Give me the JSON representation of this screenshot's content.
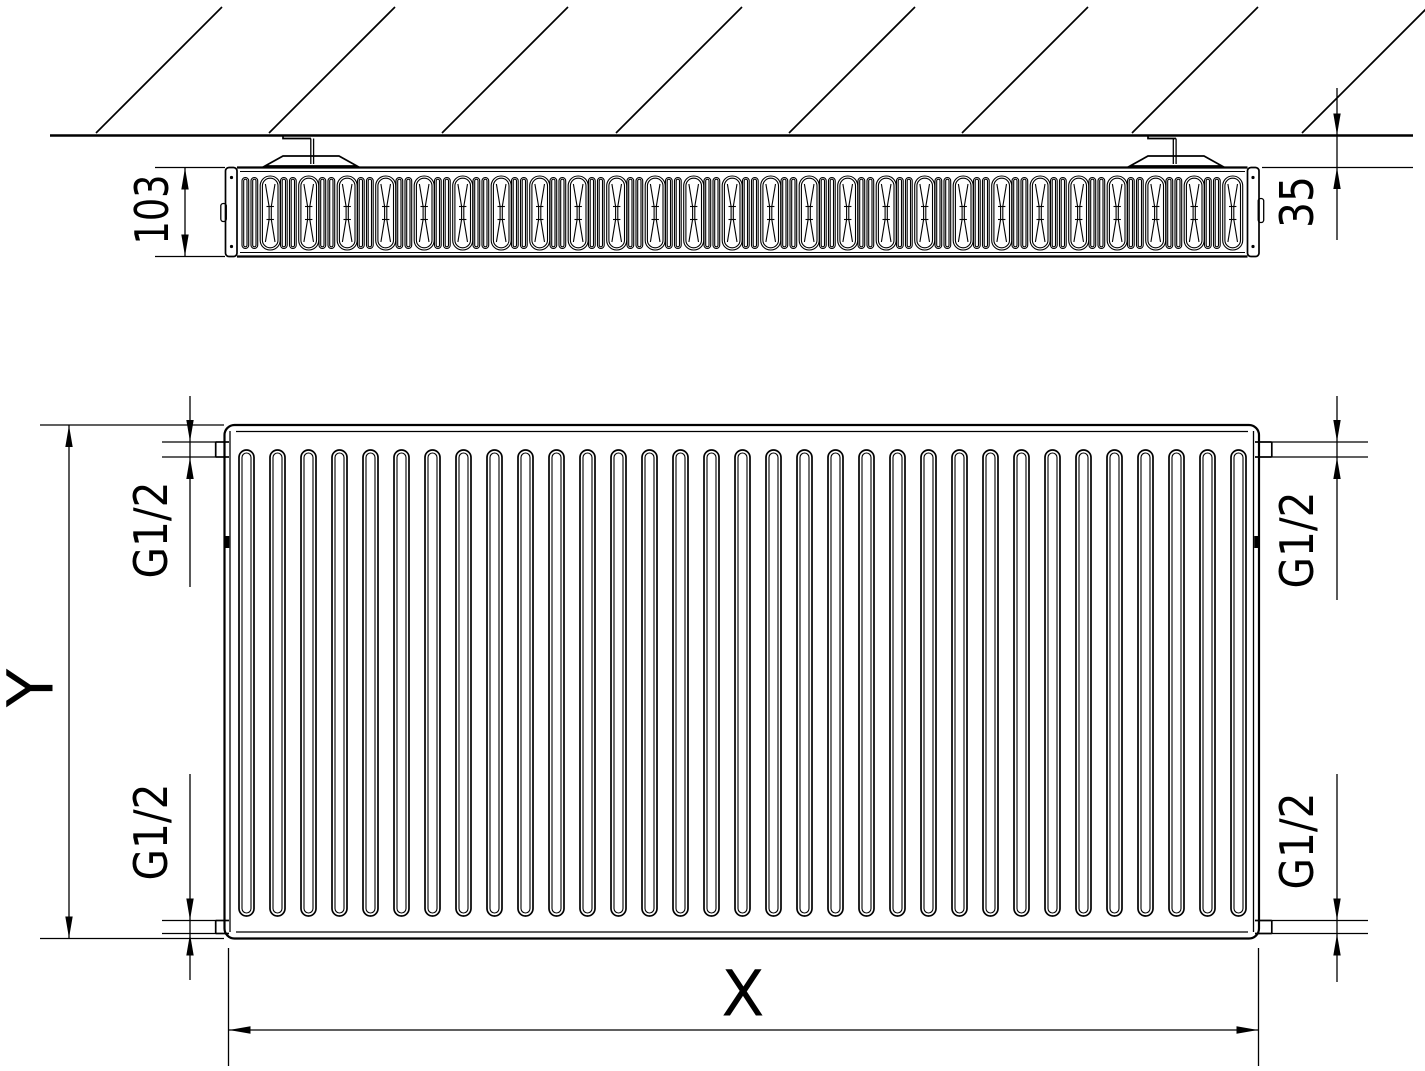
{
  "drawing": {
    "type": "radiator-technical-drawing",
    "background_color": "#ffffff",
    "line_color": "#000000",
    "views": {
      "top_view": {
        "description": "horizontal cross-section of radiator mounted on wall",
        "dimensions": {
          "depth_label": "103",
          "wall_clearance_label": "35"
        }
      },
      "front_view": {
        "description": "front elevation of corrugated panel radiator",
        "dimensions": {
          "height_label": "Y",
          "width_label": "X",
          "thread_top_left": "G1/2",
          "thread_bottom_left": "G1/2",
          "thread_top_right": "G1/2",
          "thread_bottom_right": "G1/2"
        }
      }
    },
    "geometry": {
      "hatch_x_positions": [
        96,
        269,
        442,
        616,
        789,
        962,
        1132,
        1302
      ],
      "hatch_rise": 126,
      "wall_line_y": 135,
      "fin_pattern": {
        "start_x": 242,
        "end_x": 1246,
        "period": 38.5,
        "top_y": 176,
        "bottom_y": 250
      },
      "corrugations": {
        "count": 33,
        "start_center_x": 246.5,
        "spacing": 31,
        "top_y": 450,
        "bottom_y": 916
      }
    }
  }
}
